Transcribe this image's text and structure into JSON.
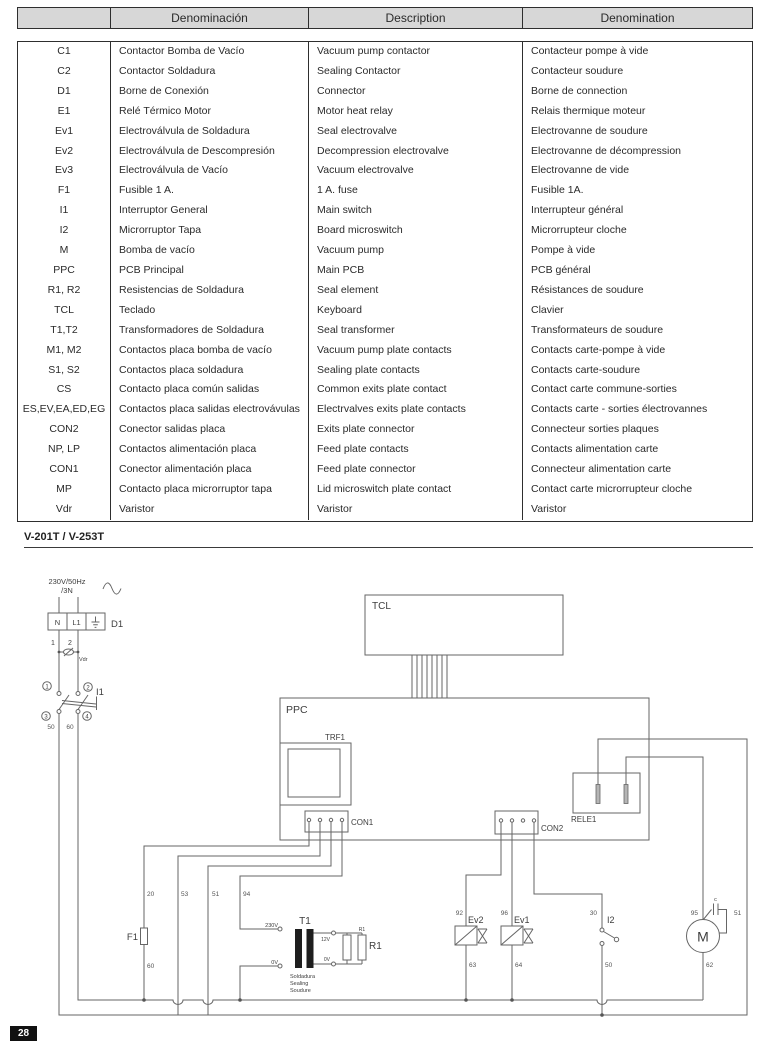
{
  "page": {
    "number": "28",
    "section_title": "V-201T / V-253T"
  },
  "table": {
    "headers": {
      "code": "",
      "es": "Denominación",
      "en": "Description",
      "fr": "Denomination"
    },
    "rows": [
      {
        "code": "C1",
        "es": "Contactor Bomba de Vacío",
        "en": "Vacuum pump contactor",
        "fr": "Contacteur pompe à vide"
      },
      {
        "code": "C2",
        "es": "Contactor Soldadura",
        "en": "Sealing Contactor",
        "fr": "Contacteur soudure"
      },
      {
        "code": "D1",
        "es": "Borne de Conexión",
        "en": "Connector",
        "fr": "Borne de connection"
      },
      {
        "code": "E1",
        "es": "Relé Térmico Motor",
        "en": "Motor heat relay",
        "fr": "Relais thermique moteur"
      },
      {
        "code": "Ev1",
        "es": "Electroválvula de Soldadura",
        "en": "Seal electrovalve",
        "fr": "Electrovanne de soudure"
      },
      {
        "code": "Ev2",
        "es": "Electroválvula de Descompresión",
        "en": "Decompression electrovalve",
        "fr": "Electrovanne de décompression"
      },
      {
        "code": "Ev3",
        "es": "Electroválvula de Vacío",
        "en": "Vacuum electrovalve",
        "fr": "Electrovanne de vide"
      },
      {
        "code": "F1",
        "es": "Fusible 1 A.",
        "en": "1 A. fuse",
        "fr": "Fusible 1A."
      },
      {
        "code": "I1",
        "es": "Interruptor General",
        "en": "Main switch",
        "fr": "Interrupteur général"
      },
      {
        "code": "I2",
        "es": "Microrruptor Tapa",
        "en": "Board microswitch",
        "fr": "Microrrupteur cloche"
      },
      {
        "code": "M",
        "es": "Bomba de vacío",
        "en": "Vacuum pump",
        "fr": "Pompe à vide"
      },
      {
        "code": "PPC",
        "es": "PCB Principal",
        "en": "Main PCB",
        "fr": "PCB général"
      },
      {
        "code": "R1, R2",
        "es": "Resistencias de Soldadura",
        "en": "Seal element",
        "fr": "Résistances de soudure"
      },
      {
        "code": "TCL",
        "es": "Teclado",
        "en": "Keyboard",
        "fr": "Clavier"
      },
      {
        "code": "T1,T2",
        "es": "Transformadores de Soldadura",
        "en": "Seal transformer",
        "fr": "Transformateurs de soudure"
      },
      {
        "code": "M1, M2",
        "es": "Contactos placa bomba de vacío",
        "en": "Vacuum pump plate contacts",
        "fr": "Contacts carte-pompe à vide"
      },
      {
        "code": "S1, S2",
        "es": "Contactos placa soldadura",
        "en": "Sealing plate contacts",
        "fr": "Contacts carte-soudure"
      },
      {
        "code": "CS",
        "es": "Contacto placa común salidas",
        "en": "Common exits plate contact",
        "fr": "Contact carte commune-sorties"
      },
      {
        "code": "ES,EV,EA,ED,EG",
        "es": "Contactos placa salidas electrovávulas",
        "en": "Electrvalves exits plate contacts",
        "fr": "Contacts carte - sorties électrovannes"
      },
      {
        "code": "CON2",
        "es": "Conector salidas placa",
        "en": "Exits plate connector",
        "fr": "Connecteur sorties plaques"
      },
      {
        "code": "NP, LP",
        "es": "Contactos alimentación placa",
        "en": "Feed plate contacts",
        "fr": "Contacts alimentation carte"
      },
      {
        "code": "CON1",
        "es": "Conector alimentación placa",
        "en": "Feed plate connector",
        "fr": "Connecteur alimentation carte"
      },
      {
        "code": "MP",
        "es": "Contacto placa microrruptor tapa",
        "en": "Lid microswitch plate contact",
        "fr": "Contact carte microrrupteur cloche"
      },
      {
        "code": "Vdr",
        "es": "Varistor",
        "en": "Varistor",
        "fr": "Varistor"
      }
    ]
  },
  "diagram": {
    "supply": {
      "line1": "230V/50Hz",
      "line2": "/3N"
    },
    "d1": {
      "label": "D1",
      "cell_n": "N",
      "cell_l1": "L1",
      "pin1": "1",
      "pin2": "2"
    },
    "vdr": "Vdr",
    "i1": {
      "label": "I1",
      "t1": "1",
      "t2": "2",
      "t3": "3",
      "t4": "4",
      "w50": "50",
      "w60": "60"
    },
    "tcl": "TCL",
    "ppc": "PPC",
    "trf1": "TRF1",
    "con1": "CON1",
    "con2": "CON2",
    "rele1": "RELE1",
    "f1": "F1",
    "wire_labels": {
      "w20": "20",
      "w53": "53",
      "w51": "51",
      "w94": "94",
      "w60": "60",
      "w92": "92",
      "w96": "96",
      "w30": "30",
      "w63": "63",
      "w64": "64",
      "w50": "50",
      "w95": "95",
      "w51b": "51",
      "w62": "62"
    },
    "t1": {
      "label": "T1",
      "prim_top": "230V",
      "prim_bot": "0V",
      "sec_top": "12V",
      "sec_bot": "0V",
      "r1_small": "R1",
      "r1": "R1",
      "cap1": "Soldadura",
      "cap2": "Sealing",
      "cap3": "Soudure"
    },
    "ev2": "Ev2",
    "ev1": "Ev1",
    "i2": "I2",
    "motor": "M",
    "cap": "c"
  }
}
